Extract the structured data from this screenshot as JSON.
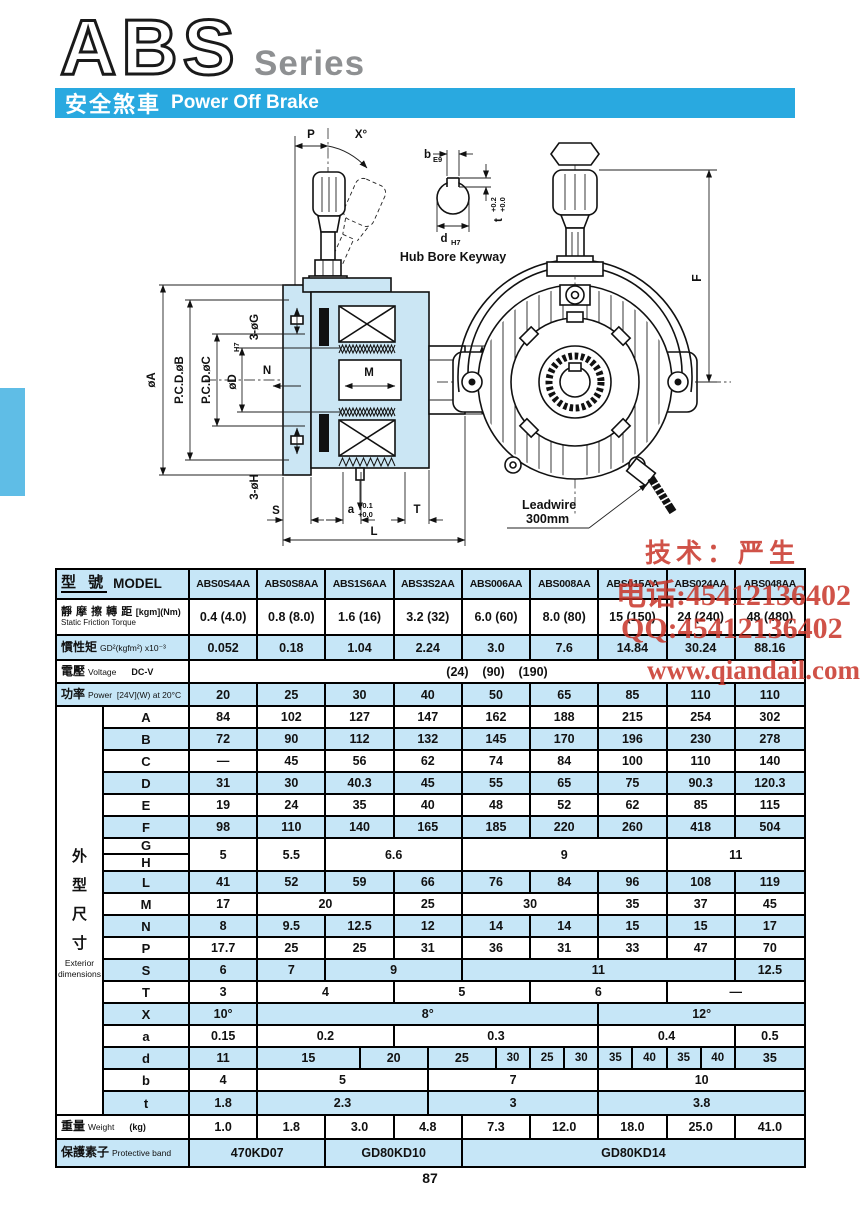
{
  "page": {
    "number": "87"
  },
  "header": {
    "logo": "ABS",
    "series": "Series",
    "banner_zh": "安全煞車",
    "banner_en": "Power Off Brake"
  },
  "watermark": {
    "line1": "技术：严生",
    "line2": "电话:45412136402",
    "line3": "QQ:45412136402",
    "line4": "www.qiandail.com"
  },
  "diagram": {
    "left": {
      "p": "P",
      "x_angle": "X°",
      "phi_a": "øA",
      "pcd_b": "P.C.D.øB",
      "pcd_c": "P.C.D.øC",
      "phi_d": "øD",
      "phi_d_tol": "H7",
      "n": "N",
      "m": "M",
      "phi_e": "øE",
      "g_holes": "3-øG",
      "h_holes": "3-øH",
      "s": "S",
      "a": "a",
      "a_tol_top": "+0.1",
      "a_tol_bot": "+0.0",
      "t": "T",
      "l": "L"
    },
    "hub": {
      "b": "b",
      "b_tol": "E9",
      "d": "d",
      "d_tol": "H7",
      "t": "t",
      "t_tol_top": "+0.2",
      "t_tol_bot": "+0.0",
      "caption": "Hub Bore Keyway"
    },
    "front": {
      "f": "F",
      "leadwire_1": "Leadwire",
      "leadwire_2": "300mm"
    }
  },
  "table": {
    "header": {
      "zh": "型  號",
      "en": "MODEL",
      "models": [
        "ABS0S4AA",
        "ABS0S8AA",
        "ABS1S6AA",
        "ABS3S2AA",
        "ABS006AA",
        "ABS008AA",
        "ABS015AA",
        "ABS024AA",
        "ABS048AA"
      ]
    },
    "spec_rows": [
      {
        "id": "torque",
        "h": 36,
        "shade": false,
        "two_line": true,
        "zh": "靜 摩 擦 轉 距",
        "unit": "[kgm](Nm)",
        "en": "Static Friction Torque",
        "cells": [
          {
            "t": "0.4 (4.0)",
            "s": 2
          },
          {
            "t": "0.8 (8.0)",
            "s": 2
          },
          {
            "t": "1.6 (16)",
            "s": 2
          },
          {
            "t": "3.2 (32)",
            "s": 2
          },
          {
            "t": "6.0 (60)",
            "s": 2
          },
          {
            "t": "8.0 (80)",
            "s": 2
          },
          {
            "t": "15 (150)",
            "s": 2
          },
          {
            "t": "24 (240)",
            "s": 2
          },
          {
            "t": "48 (480)",
            "s": 2
          }
        ]
      },
      {
        "id": "inertia",
        "h": 25,
        "shade": true,
        "zh": "慣性矩",
        "en": "GD²(kgfm²) x10⁻³",
        "cells": [
          {
            "t": "0.052",
            "s": 2
          },
          {
            "t": "0.18",
            "s": 2
          },
          {
            "t": "1.04",
            "s": 2
          },
          {
            "t": "2.24",
            "s": 2
          },
          {
            "t": "3.0",
            "s": 2
          },
          {
            "t": "7.6",
            "s": 2
          },
          {
            "t": "14.84",
            "s": 2
          },
          {
            "t": "30.24",
            "s": 2
          },
          {
            "t": "88.16",
            "s": 2
          }
        ]
      },
      {
        "id": "voltage",
        "h": 23,
        "shade": false,
        "pre": true,
        "zh": "電壓",
        "en": "Voltage",
        "unit": "DC-V",
        "cells": [
          {
            "t": "(24)    (90)    (190)",
            "s": 18
          }
        ]
      },
      {
        "id": "power",
        "h": 23,
        "shade": true,
        "zh": "功率",
        "en": "Power  [24V](W) at 20°C",
        "cells": [
          {
            "t": "20",
            "s": 2
          },
          {
            "t": "25",
            "s": 2
          },
          {
            "t": "30",
            "s": 2
          },
          {
            "t": "40",
            "s": 2
          },
          {
            "t": "50",
            "s": 2
          },
          {
            "t": "65",
            "s": 2
          },
          {
            "t": "85",
            "s": 2
          },
          {
            "t": "110",
            "s": 2
          },
          {
            "t": "110",
            "s": 2
          }
        ]
      }
    ],
    "dims_label": {
      "zh": "外型尺寸",
      "en1": "Exterior",
      "en2": "dimensions"
    },
    "dim_rows": [
      {
        "label": "A",
        "shade": false,
        "cells": [
          {
            "t": "84",
            "s": 2
          },
          {
            "t": "102",
            "s": 2
          },
          {
            "t": "127",
            "s": 2
          },
          {
            "t": "147",
            "s": 2
          },
          {
            "t": "162",
            "s": 2
          },
          {
            "t": "188",
            "s": 2
          },
          {
            "t": "215",
            "s": 2
          },
          {
            "t": "254",
            "s": 2
          },
          {
            "t": "302",
            "s": 2
          }
        ]
      },
      {
        "label": "B",
        "shade": true,
        "cells": [
          {
            "t": "72",
            "s": 2
          },
          {
            "t": "90",
            "s": 2
          },
          {
            "t": "112",
            "s": 2
          },
          {
            "t": "132",
            "s": 2
          },
          {
            "t": "145",
            "s": 2
          },
          {
            "t": "170",
            "s": 2
          },
          {
            "t": "196",
            "s": 2
          },
          {
            "t": "230",
            "s": 2
          },
          {
            "t": "278",
            "s": 2
          }
        ]
      },
      {
        "label": "C",
        "shade": false,
        "cells": [
          {
            "t": "—",
            "s": 2
          },
          {
            "t": "45",
            "s": 2
          },
          {
            "t": "56",
            "s": 2
          },
          {
            "t": "62",
            "s": 2
          },
          {
            "t": "74",
            "s": 2
          },
          {
            "t": "84",
            "s": 2
          },
          {
            "t": "100",
            "s": 2
          },
          {
            "t": "110",
            "s": 2
          },
          {
            "t": "140",
            "s": 2
          }
        ]
      },
      {
        "label": "D",
        "shade": true,
        "cells": [
          {
            "t": "31",
            "s": 2
          },
          {
            "t": "30",
            "s": 2
          },
          {
            "t": "40.3",
            "s": 2
          },
          {
            "t": "45",
            "s": 2
          },
          {
            "t": "55",
            "s": 2
          },
          {
            "t": "65",
            "s": 2
          },
          {
            "t": "75",
            "s": 2
          },
          {
            "t": "90.3",
            "s": 2
          },
          {
            "t": "120.3",
            "s": 2
          }
        ]
      },
      {
        "label": "E",
        "shade": false,
        "cells": [
          {
            "t": "19",
            "s": 2
          },
          {
            "t": "24",
            "s": 2
          },
          {
            "t": "35",
            "s": 2
          },
          {
            "t": "40",
            "s": 2
          },
          {
            "t": "48",
            "s": 2
          },
          {
            "t": "52",
            "s": 2
          },
          {
            "t": "62",
            "s": 2
          },
          {
            "t": "85",
            "s": 2
          },
          {
            "t": "115",
            "s": 2
          }
        ]
      },
      {
        "label": "F",
        "shade": true,
        "cells": [
          {
            "t": "98",
            "s": 2
          },
          {
            "t": "110",
            "s": 2
          },
          {
            "t": "140",
            "s": 2
          },
          {
            "t": "165",
            "s": 2
          },
          {
            "t": "185",
            "s": 2
          },
          {
            "t": "220",
            "s": 2
          },
          {
            "t": "260",
            "s": 2
          },
          {
            "t": "418",
            "s": 2
          },
          {
            "t": "504",
            "s": 2
          }
        ]
      },
      {
        "label": "G",
        "label2": "H",
        "shade": false,
        "cells": [
          {
            "t": "5",
            "s": 2
          },
          {
            "t": "5.5",
            "s": 2
          },
          {
            "t": "6.6",
            "s": 4
          },
          {
            "t": "9",
            "s": 6
          },
          {
            "t": "11",
            "s": 4
          }
        ]
      },
      {
        "label": "L",
        "shade": true,
        "cells": [
          {
            "t": "41",
            "s": 2
          },
          {
            "t": "52",
            "s": 2
          },
          {
            "t": "59",
            "s": 2
          },
          {
            "t": "66",
            "s": 2
          },
          {
            "t": "76",
            "s": 2
          },
          {
            "t": "84",
            "s": 2
          },
          {
            "t": "96",
            "s": 2
          },
          {
            "t": "108",
            "s": 2
          },
          {
            "t": "119",
            "s": 2
          }
        ]
      },
      {
        "label": "M",
        "shade": false,
        "cells": [
          {
            "t": "17",
            "s": 2
          },
          {
            "t": "20",
            "s": 4
          },
          {
            "t": "25",
            "s": 2
          },
          {
            "t": "30",
            "s": 4
          },
          {
            "t": "35",
            "s": 2
          },
          {
            "t": "37",
            "s": 2
          },
          {
            "t": "45",
            "s": 2
          }
        ]
      },
      {
        "label": "N",
        "shade": true,
        "cells": [
          {
            "t": "8",
            "s": 2
          },
          {
            "t": "9.5",
            "s": 2
          },
          {
            "t": "12.5",
            "s": 2
          },
          {
            "t": "12",
            "s": 2
          },
          {
            "t": "14",
            "s": 2
          },
          {
            "t": "14",
            "s": 2
          },
          {
            "t": "15",
            "s": 2
          },
          {
            "t": "15",
            "s": 2
          },
          {
            "t": "17",
            "s": 2
          }
        ]
      },
      {
        "label": "P",
        "shade": false,
        "cells": [
          {
            "t": "17.7",
            "s": 2
          },
          {
            "t": "25",
            "s": 2
          },
          {
            "t": "25",
            "s": 2
          },
          {
            "t": "31",
            "s": 2
          },
          {
            "t": "36",
            "s": 2
          },
          {
            "t": "31",
            "s": 2
          },
          {
            "t": "33",
            "s": 2
          },
          {
            "t": "47",
            "s": 2
          },
          {
            "t": "70",
            "s": 2
          }
        ]
      },
      {
        "label": "S",
        "shade": true,
        "cells": [
          {
            "t": "6",
            "s": 2
          },
          {
            "t": "7",
            "s": 2
          },
          {
            "t": "9",
            "s": 4
          },
          {
            "t": "11",
            "s": 8
          },
          {
            "t": "12.5",
            "s": 2
          }
        ]
      },
      {
        "label": "T",
        "shade": false,
        "cells": [
          {
            "t": "3",
            "s": 2
          },
          {
            "t": "4",
            "s": 4
          },
          {
            "t": "5",
            "s": 4
          },
          {
            "t": "6",
            "s": 4
          },
          {
            "t": "—",
            "s": 4
          }
        ]
      },
      {
        "label": "X",
        "shade": true,
        "cells": [
          {
            "t": "10°",
            "s": 2
          },
          {
            "t": "8°",
            "s": 10
          },
          {
            "t": "12°",
            "s": 6
          }
        ]
      },
      {
        "label": "a",
        "shade": false,
        "cells": [
          {
            "t": "0.15",
            "s": 2
          },
          {
            "t": "0.2",
            "s": 4
          },
          {
            "t": "0.3",
            "s": 6
          },
          {
            "t": "0.4",
            "s": 4
          },
          {
            "t": "0.5",
            "s": 2
          }
        ]
      },
      {
        "label": "d",
        "shade": true,
        "cells": [
          {
            "t": "11",
            "s": 2
          },
          {
            "t": "15",
            "s": 3
          },
          {
            "t": "20",
            "s": 2
          },
          {
            "t": "25",
            "s": 2
          },
          {
            "t": "30",
            "s": 1
          },
          {
            "t": "25",
            "s": 1
          },
          {
            "t": "30",
            "s": 1
          },
          {
            "t": "35",
            "s": 1
          },
          {
            "t": "40",
            "s": 1
          },
          {
            "t": "35",
            "s": 1
          },
          {
            "t": "40",
            "s": 1
          },
          {
            "t": "35",
            "s": 2
          }
        ]
      },
      {
        "label": "b",
        "shade": false,
        "cells": [
          {
            "t": "4",
            "s": 2
          },
          {
            "t": "5",
            "s": 5
          },
          {
            "t": "7",
            "s": 5
          },
          {
            "t": "10",
            "s": 6
          }
        ]
      },
      {
        "label": "t",
        "shade": true,
        "cells": [
          {
            "t": "1.8",
            "s": 2
          },
          {
            "t": "2.3",
            "s": 5
          },
          {
            "t": "3",
            "s": 5
          },
          {
            "t": "3.8",
            "s": 6
          }
        ]
      }
    ],
    "bottom_rows": [
      {
        "id": "weight",
        "h": 24,
        "shade": false,
        "zh": "重量",
        "en": "Weight",
        "unit": "(kg)",
        "cells": [
          {
            "t": "1.0",
            "s": 2
          },
          {
            "t": "1.8",
            "s": 2
          },
          {
            "t": "3.0",
            "s": 2
          },
          {
            "t": "4.8",
            "s": 2
          },
          {
            "t": "7.3",
            "s": 2
          },
          {
            "t": "12.0",
            "s": 2
          },
          {
            "t": "18.0",
            "s": 2
          },
          {
            "t": "25.0",
            "s": 2
          },
          {
            "t": "41.0",
            "s": 2
          }
        ]
      },
      {
        "id": "protect",
        "h": 26,
        "shade": true,
        "zh": "保護素子",
        "en": "Protective band",
        "cells": [
          {
            "t": "470KD07",
            "s": 4
          },
          {
            "t": "GD80KD10",
            "s": 4
          },
          {
            "t": "GD80KD14",
            "s": 10
          }
        ]
      }
    ]
  }
}
